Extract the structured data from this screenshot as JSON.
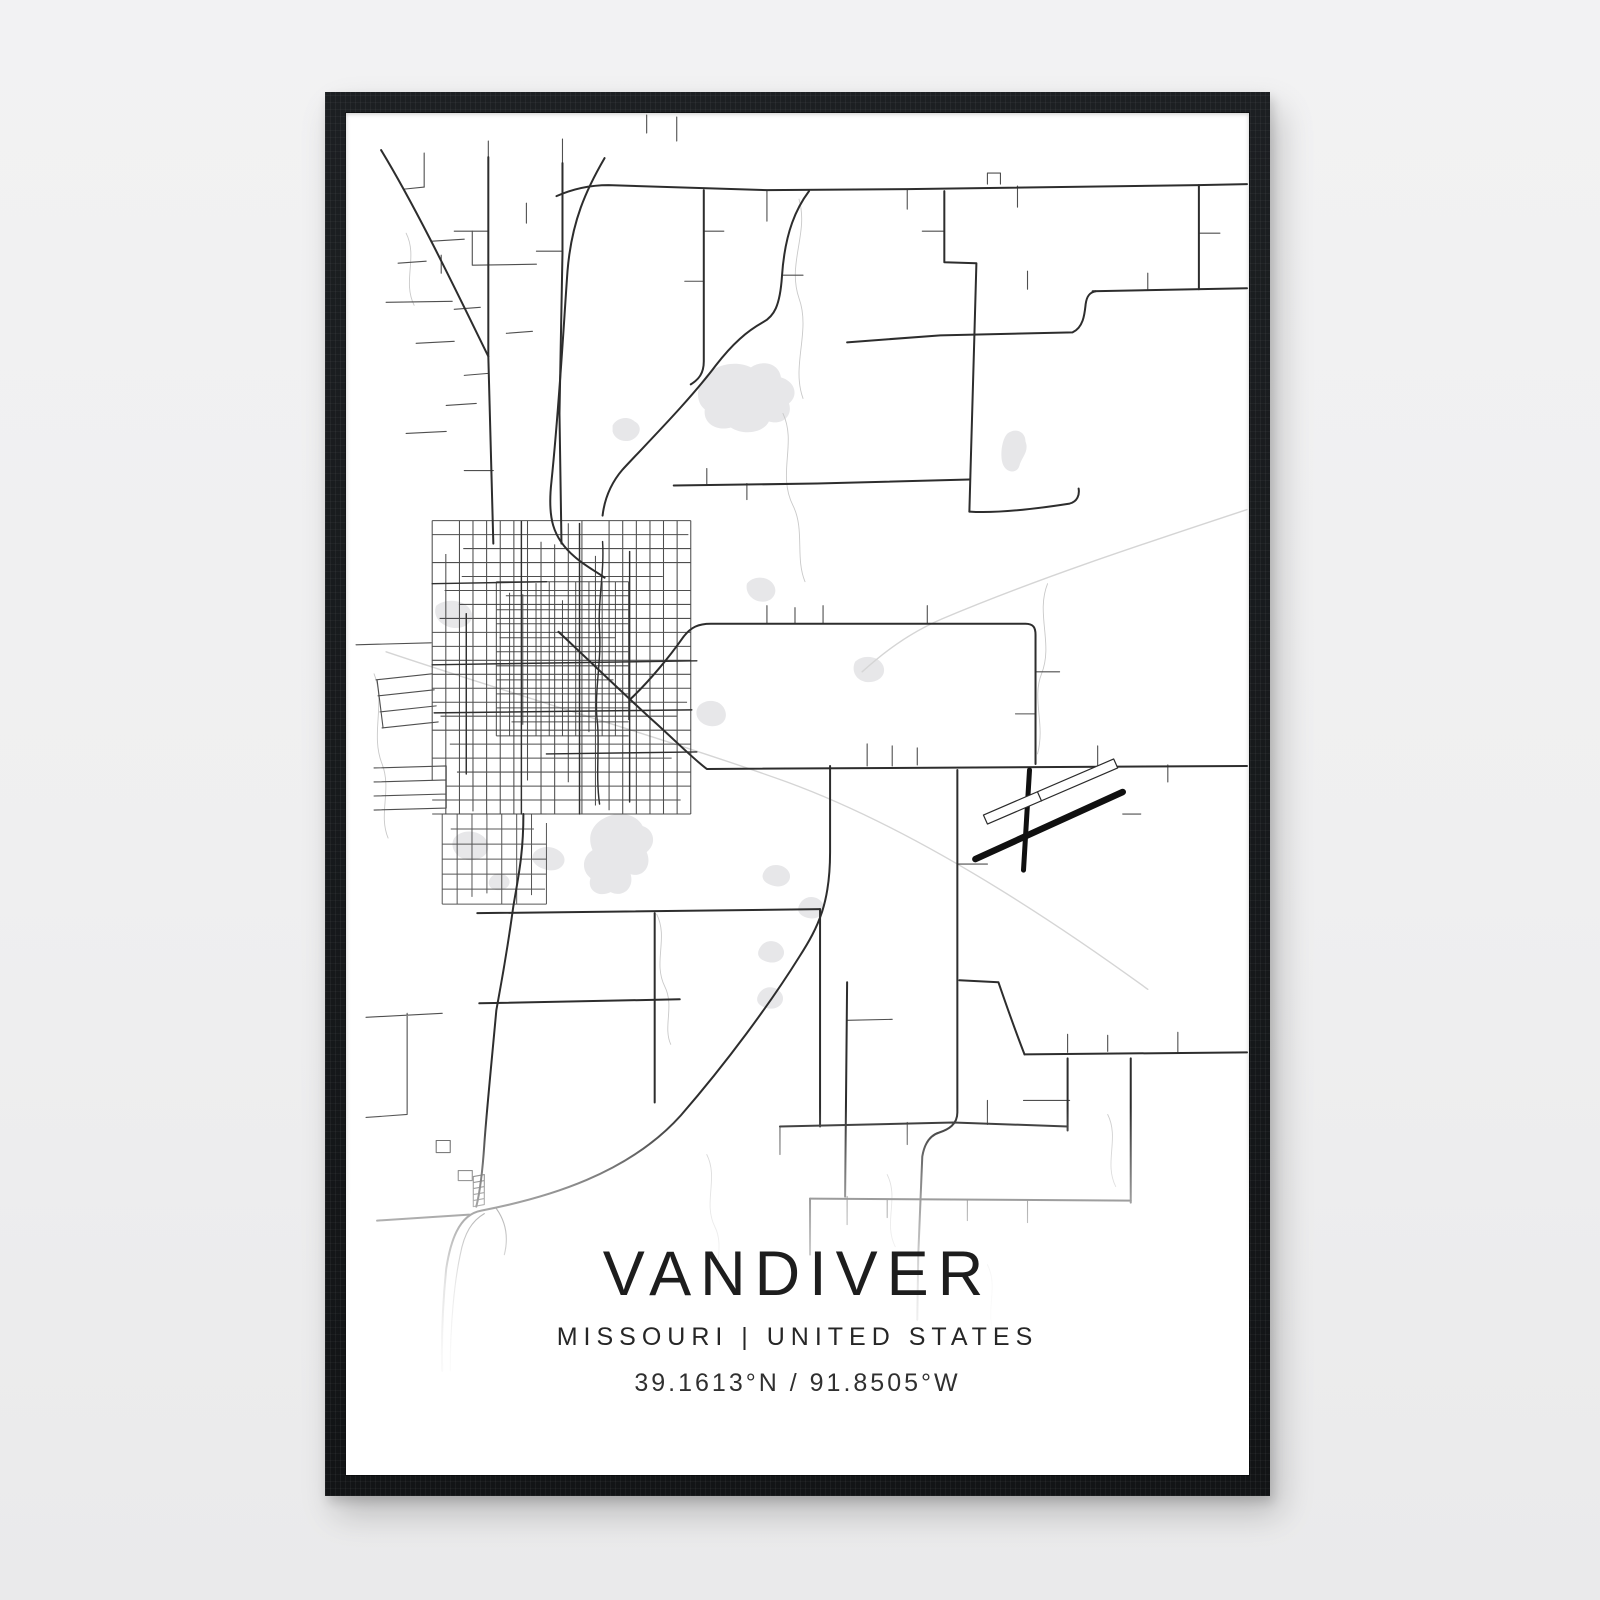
{
  "poster": {
    "title": "VANDIVER",
    "subtitle": "MISSOURI | UNITED STATES",
    "coordinates": "39.1613°N / 91.8505°W"
  },
  "colors": {
    "wall_background": "#efeff0",
    "frame": "#17191c",
    "poster_background": "#ffffff",
    "road_major": "#2d2d2d",
    "road_town": "#303030",
    "road_minor": "#4f4f4f",
    "road_grid": "#3f3f3f",
    "railroad_faint": "#d5d5d5",
    "stream": "#c9c9c9",
    "water": "#e7e7e9",
    "runway": "#101010",
    "text": "#1d1d1d"
  },
  "map": {
    "viewbox": "0 0 901 1360",
    "layers": [
      {
        "name": "water",
        "fill": "#e7e7e9"
      },
      {
        "name": "streams",
        "stroke": "#c9c9c9",
        "width": 0.9
      },
      {
        "name": "faint",
        "stroke": "#d5d5d5",
        "width": 1.4
      },
      {
        "name": "grids",
        "grid": true
      },
      {
        "name": "minor",
        "stroke": "#4f4f4f",
        "width": 1.1
      },
      {
        "name": "town",
        "stroke": "#303030",
        "width": 1.45
      },
      {
        "name": "major",
        "stroke": "#2d2d2d",
        "width": 2
      },
      {
        "name": "runway",
        "stroke": "#101010",
        "width": 5
      }
    ],
    "water": [
      "M358,264 C366,252 388,246 404,254 C416,246 432,250 434,264 C448,268 452,282 442,290 C446,302 436,312 422,308 C416,320 396,322 384,314 C370,318 356,310 358,296 C348,288 350,272 358,264 Z",
      "M266,312 C270,304 282,302 288,308 C296,312 294,322 286,326 C278,330 268,326 266,318 Z",
      "M660,320 C668,314 678,318 678,328 C682,338 674,344 672,352 C670,360 660,360 656,352 C652,344 654,326 660,320 Z",
      "M400,470 C406,462 420,462 426,470 C432,478 426,488 416,488 C406,488 398,480 400,470 Z",
      "M508,548 C516,540 532,542 536,552 C540,562 530,570 518,568 C508,566 504,556 508,548 Z",
      "M90,492 C100,484 118,486 124,496 C130,506 120,516 106,514 C94,512 86,502 90,492 Z",
      "M352,592 C360,584 374,586 378,596 C382,606 374,614 362,612 C352,610 346,600 352,592 Z",
      "M258,704 C272,696 290,700 296,712 C308,716 310,730 300,738 C306,752 296,764 284,760 C288,774 276,784 264,778 C252,784 240,776 244,764 C234,756 236,742 246,736 C240,722 246,710 258,704 Z",
      "M108,724 C116,714 134,716 140,726 C146,736 138,746 124,746 C112,746 102,734 108,724 Z",
      "M188,738 C196,730 210,732 216,740 C222,748 214,758 202,756 C190,754 182,746 188,738 Z",
      "M144,764 C148,758 158,758 162,764 C166,770 160,776 152,776 C144,776 140,770 144,764 Z",
      "M418,756 C424,748 438,750 442,758 C446,766 438,774 428,772 C418,770 412,764 418,756 Z",
      "M454,788 C460,780 472,782 476,790 C480,798 472,806 462,804 C452,802 448,796 454,788 Z",
      "M414,832 C420,824 432,826 436,834 C440,842 432,850 422,848 C412,846 408,840 414,832 Z",
      "M413,878 C419,870 431,872 435,880 C439,888 431,896 421,894 C411,892 407,886 413,878 Z"
    ],
    "streams": [
      "M452,86 C462,120 440,150 452,185 C464,218 444,252 456,285",
      "M436,300 C450,330 430,360 446,392 C458,416 448,444 458,468",
      "M700,470 C688,500 706,530 694,560 C684,585 698,610 690,640",
      "M360,1040 C372,1064 356,1088 368,1112 C378,1132 366,1152 374,1170",
      "M28,560 C40,590 24,620 36,650 C46,676 32,700 42,724",
      "M310,800 C322,824 306,848 318,872 C328,892 316,912 324,930",
      "M540,1060 C552,1084 536,1108 548,1132",
      "M60,120 C72,144 56,168 68,192",
      "M640,1150 C652,1174 636,1198 648,1222",
      "M760,1000 C772,1024 756,1048 768,1072"
    ],
    "faint": [
      "M40,538 C180,585 320,625 440,668 C560,712 690,795 800,875",
      "M899,396 C790,432 690,465 595,505 C560,520 535,540 515,558"
    ],
    "minor": [
      "M420,77 L420,108",
      "M560,76 L560,96",
      "M670,73 L670,94",
      "M640,71 L640,60 L653,60 L653,71",
      "M142,118 L108,118",
      "M126,118 L126,152 L190,151",
      "M216,138 L190,138",
      "M147,357 L118,357",
      "M357,118 L377,118",
      "M357,168 L338,168",
      "M435,162 L456,162",
      "M597,118 L575,118",
      "M58,76 L78,74",
      "M86,128 L118,126",
      "M52,150 L80,148",
      "M95,160 L95,142",
      "M108,196 L134,194",
      "M70,230 L108,228",
      "M118,262 L142,260",
      "M100,292 L130,290",
      "M60,320 L100,318",
      "M78,40 L78,74",
      "M180,90 L180,110",
      "M160,220 L186,218",
      "M520,652 L520,630",
      "M545,652 L545,632",
      "M570,651 L570,634",
      "M420,510 L420,492",
      "M448,510 L448,494",
      "M476,510 L476,492",
      "M580,510 L580,492",
      "M688,558 L712,558",
      "M688,600 L668,600",
      "M610,750 L640,750",
      "M793,700 L775,700",
      "M720,938 L720,920",
      "M760,937 L760,921",
      "M830,938 L830,918",
      "M852,120 L872,120",
      "M680,176 L680,158",
      "M800,176 L800,160",
      "M360,371 L360,355",
      "M400,370 L400,386",
      "M500,906 L545,905",
      "M500,1082 L500,1110",
      "M433,1012 L433,1040",
      "M560,1008 L560,1030",
      "M640,1010 L640,986",
      "M680,1086 L680,1108",
      "M620,1086 L620,1106",
      "M540,1085 L540,1103",
      "M750,652 L750,632",
      "M820,651 L820,668",
      "M30,566 L86,560 M32,582 L88,576 M34,598 L90,592 M36,614 L92,608 M31,566 L37,614",
      "M28,654 L100,652 M28,668 L100,666 M28,682 L100,680 M28,696 L100,694 M100,652 L100,694",
      "M20,903 L96,899 M61,899 L61,1000 M20,1003 L61,1000",
      "M10,531 L85,529",
      "M40,189 L106,188",
      "M216,26 L216,50",
      "M300,20 L300,2",
      "M330,28 L330,4",
      "M142,28 L142,46",
      "M112,1056 L126,1056 L126,1066 L112,1066 Z",
      "M90,1026 L104,1026 L104,1038 L90,1038 Z",
      "M127,1062 L138,1060 M127,1068 L138,1066 M127,1074 L138,1072 M127,1080 L138,1078 M127,1086 L138,1084 M127,1092 L138,1090 M127,1062 L127,1092 M138,1060 L138,1090",
      "M104,1256 C104,1210 108,1168 114,1140 C118,1118 126,1106 138,1099",
      "M150,1094 C160,1108 162,1124 158,1140",
      "M676,986 L722,986"
    ],
    "town": [
      "M86,551 L350,547",
      "M88,599 L345,596",
      "M233,410 L233,700",
      "M175,408 L175,700",
      "M283,438 L283,688",
      "M256,428 C258,458 251,488 253,518 C255,550 247,580 251,610 C253,634 249,662 253,690",
      "M120,500 L120,660",
      "M86,470 L200,468",
      "M200,640 L350,638"
    ],
    "major": [
      "M210,83 C228,75 244,72 262,72 L420,77 L560,76 L850,72 L899,71",
      "M35,37 C72,98 112,182 142,243",
      "M142,44 L142,243 L147,430",
      "M216,50 L216,140 L213,300 L215,430",
      "M258,45 C240,76 225,108 221,158 C217,214 213,290 205,368 C201,404 206,424 228,443 C238,452 250,458 258,464",
      "M462,78 C450,94 438,118 435,163 C433,193 427,203 416,209 C400,218 386,230 369,252 C342,288 300,330 276,356 C264,370 258,385 256,402",
      "M357,77 L357,248 C357,260 352,266 344,271",
      "M745,178 L899,175",
      "M500,229 L593,222 L725,219 C736,214 737,200 738,191 C739,183 742,179 748,178",
      "M851,72 L851,176",
      "M597,78 L597,149 L629,150 L627,222 L623,362 L622,398",
      "M622,398 C650,400 690,395 722,390 C730,388 732,381 731,375",
      "M327,372 L470,370 L622,366",
      "M212,518 C244,548 282,585 310,610 C334,632 348,646 360,655 L899,652",
      "M284,585 C302,568 322,544 336,524 C344,513 352,510 364,510 L678,510 C686,510 688,514 688,521 L688,650",
      "M483,652 L483,738 C483,788 472,812 452,843 C424,888 380,948 334,1001 C282,1059 202,1083 135,1096 C112,1100 104,1128 100,1154 C97,1184 95,1220 96,1256",
      "M177,700 C177,740 172,762 167,792 C159,850 152,884 150,896 C146,940 140,1000 138,1030 C136,1060 133,1080 130,1092",
      "M31,1106 L123,1100",
      "M500,868 L498,1082",
      "M610,656 L610,998 C610,1010 601,1015 592,1018 C582,1021 577,1030 575,1042 L571,1140 L570,1205",
      "M612,866 L651,868 C662,900 670,922 677,940",
      "M677,940 L899,938",
      "M720,944 L720,1016",
      "M783,944 L783,1088",
      "M433,1012 L606,1008 L720,1012",
      "M463,1084 L783,1086",
      "M463,1084 L463,1140",
      "M131,799 L473,795",
      "M473,795 L473,1012",
      "M133,889 L333,885",
      "M308,799 L308,988"
    ],
    "runway": [
      {
        "d": "M628,745 L775,678",
        "w": 6.5
      },
      {
        "d": "M682,656 L676,756",
        "w": 5
      },
      {
        "d": "M640,710 L770,654 L766,645 L636,701 Z",
        "w": 1.2,
        "s": "#2b2b2b",
        "f": "#ffffff"
      },
      {
        "d": "M694,687 L690,678",
        "w": 1.2,
        "s": "#2b2b2b"
      }
    ],
    "grids": [
      {
        "x0": 86,
        "x1": 344,
        "y0": 407,
        "y1": 700,
        "nx": 19,
        "ny": 21,
        "stroke": "#3f3f3f",
        "width": 1.05,
        "opacity": 0.92
      },
      {
        "x0": 150,
        "x1": 282,
        "y0": 468,
        "y1": 622,
        "nx": 10,
        "ny": 11,
        "stroke": "#3a3a3a",
        "width": 1,
        "opacity": 0.9
      },
      {
        "x0": 96,
        "x1": 200,
        "y0": 700,
        "y1": 790,
        "nx": 7,
        "ny": 6,
        "stroke": "#454545",
        "width": 1,
        "opacity": 0.9
      }
    ]
  }
}
